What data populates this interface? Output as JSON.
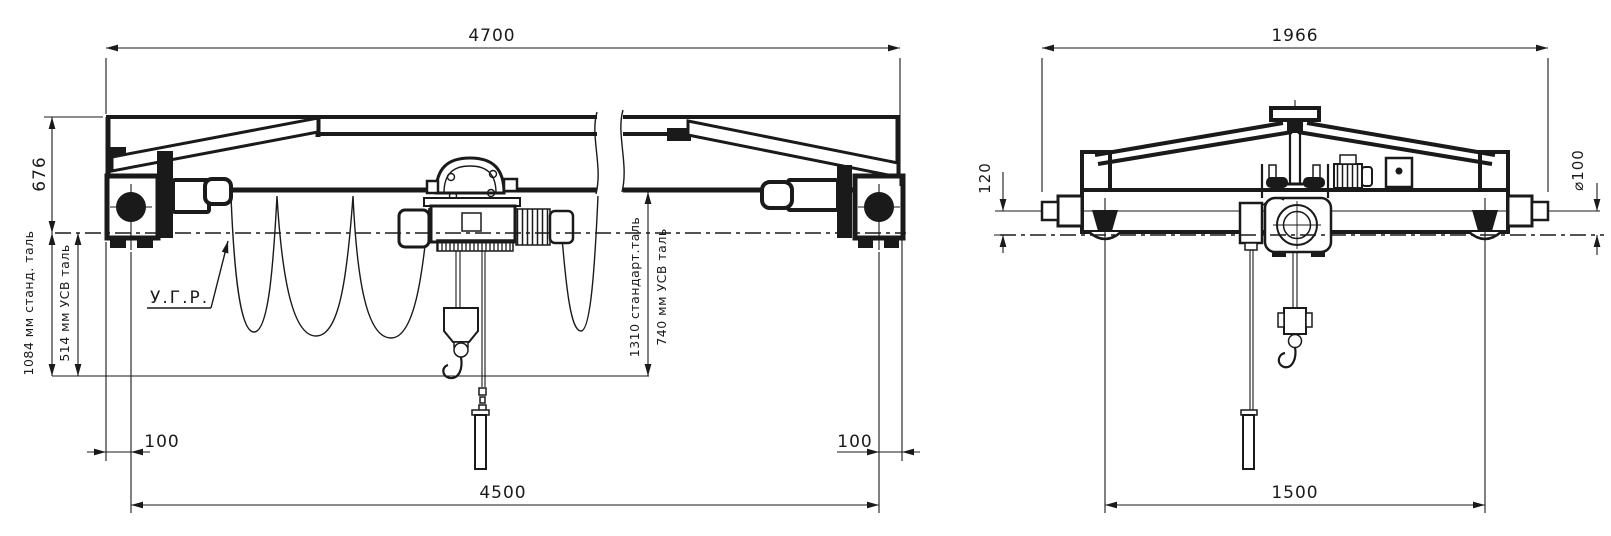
{
  "drawing_colors": {
    "line": "#1a1a1a",
    "background": "#ffffff"
  },
  "front": {
    "span": "4700",
    "height": "676",
    "hook_std": "1084 мм станд. таль",
    "hook_usv": "514 мм УСВ таль",
    "rail_label": "У.Г.Р.",
    "hoist_std": "1310 стандарт.таль",
    "hoist_usv": "740 мм УСВ таль",
    "offset_left": "100",
    "offset_right": "100",
    "wheelbase": "4500"
  },
  "side": {
    "width": "1966",
    "buffer_height": "120",
    "wheel_dia": "⌀100",
    "wheelbase": "1500"
  }
}
